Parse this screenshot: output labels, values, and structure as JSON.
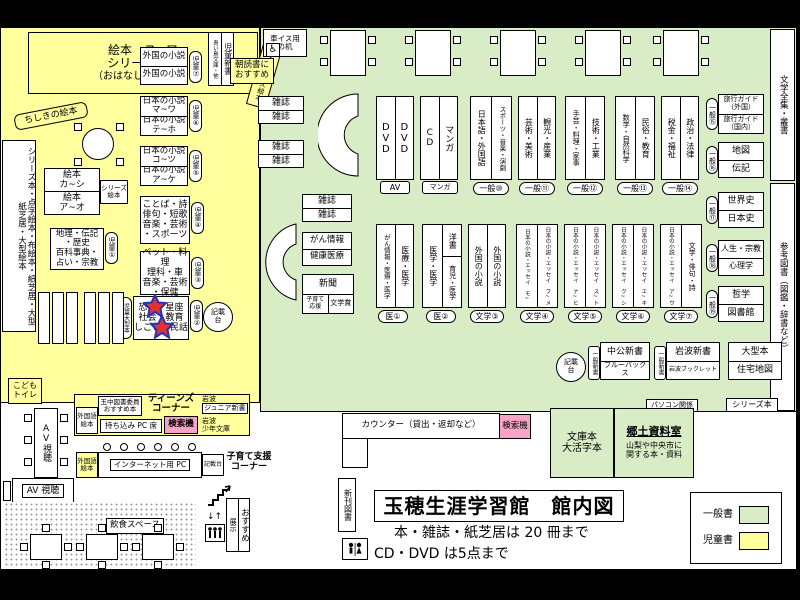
{
  "colors": {
    "children_bg": "#ffff9e",
    "general_bg": "#d8edc6",
    "search_pink": "#f9a3c6",
    "wall": "#000000"
  },
  "header": {
    "title": "玉穂生涯学習館　館内図",
    "rule_books": "本・雑誌・紙芝居は 20 冊まで",
    "rule_av": "CD・DVD は5点まで"
  },
  "legend": {
    "general": "一般書",
    "children": "児童書"
  },
  "children": {
    "ohanashi": {
      "l1": "絵本　ス~ワ",
      "l2": "シリーズ絵本",
      "l3": "（おはなしコーナー）"
    },
    "mukashi": "昔話・シリーズ絵本",
    "chishiki": "ちしきの絵本",
    "foreign": {
      "r1": "外国の小説",
      "r2": "外国の小説",
      "tag": "児童⑦"
    },
    "shinsho": {
      "main": "児童新書",
      "sub": "青い鳥文庫・他"
    },
    "asadoku": {
      "l1": "朝読書に",
      "l2": "おすすめ"
    },
    "jp1": {
      "r1": "日本の小説",
      "r2": "マ~ワ",
      "r3": "日本の小説",
      "r4": "テ~ホ",
      "tag": "児童⑥"
    },
    "jp2": {
      "r1": "日本の小説",
      "r2": "コ~ツ",
      "r3": "日本の小説",
      "r4": "ア~ケ",
      "tag": "児童⑤"
    },
    "kotoba": {
      "r1": "ことば・詩",
      "r2": "俳句・短歌",
      "r3": "音楽・芸術",
      "r4": "・スポーツ",
      "tag": "児童④"
    },
    "pet": {
      "r1": "ペット・料理",
      "r2": "理科・車",
      "r3": "音楽・芸術",
      "r4": "・保健",
      "tag": "児童③"
    },
    "star": {
      "r1": "恐竜・星座",
      "r2": "社会・教育",
      "r3": "しごと・民話",
      "tag": "児童②",
      "side": "児童大型本"
    },
    "chiri": {
      "r1": "地理・伝記",
      "r2": "・歴史",
      "r3": "百科事典・",
      "r4": "占い・宗教",
      "tag": "児童①"
    },
    "ehon1": {
      "l1": "絵本",
      "l2": "カ~シ"
    },
    "ehon2": {
      "l1": "絵本",
      "l2": "ア~オ"
    },
    "series_ehon": {
      "l1": "シリーズ",
      "l2": "絵本"
    },
    "tall_shelf": "シリーズ本・点字絵本・布絵本・紙芝居・大型紙芝居・大型絵本",
    "kisaidai": {
      "l1": "記載",
      "l2": "台"
    }
  },
  "general": {
    "wheelchair": {
      "l1": "車イス用",
      "l2": "の机"
    },
    "mag": "雑誌",
    "av": {
      "c1": "DVD",
      "c2": "DVD",
      "tag": "AV"
    },
    "cd": {
      "c1": "CD",
      "c2": "マンガ",
      "tag": "マンガ"
    },
    "s10": {
      "c1": "日本語・外国語",
      "c2": "スポーツ・音楽・演劇",
      "tag": "一般⑩"
    },
    "s11": {
      "c1": "芸術・美術",
      "c2": "観光・産業",
      "tag": "一般⑪"
    },
    "s12": {
      "c1": "手芸・料理・家事",
      "c2": "技術・工業",
      "tag": "一般⑫"
    },
    "s13": {
      "c1": "数学・自然科学",
      "c2": "民俗・教育",
      "tag": "一般⑬"
    },
    "s14": {
      "c1": "税金・福祉",
      "c2": "政治・法律",
      "tag": "一般⑭"
    },
    "r15": {
      "r1": "旅行ガイド（外国）",
      "r2": "旅行ガイド（国内）",
      "tag": "一般⑮"
    },
    "r16": {
      "r1": "地図",
      "r2": "伝記",
      "tag": "一般⑯"
    },
    "r17": {
      "r1": "世界史",
      "r2": "日本史",
      "tag": "一般⑰"
    },
    "r18": {
      "r1": "人生・宗教",
      "r2": "心理学",
      "tag": "一般⑱"
    },
    "r19": {
      "r1": "哲学",
      "r2": "図書館",
      "tag": "一般⑲"
    },
    "zenshu": "文学全集・叢書",
    "sanko": "参考図書（図鑑・辞書など）",
    "gan": {
      "r1": "がん情報",
      "r2": "健康医療"
    },
    "np": {
      "main": "新聞",
      "sub1a": "子育て",
      "sub1b": "応援",
      "sub2": "文学賞"
    },
    "m1": {
      "c1": "がん情報・医療・医学",
      "c2": "医療・医学",
      "tag": "医①"
    },
    "m2": {
      "c1": "医学・医学",
      "c2a": "洋書",
      "c2b": "育児・医学",
      "tag": "医②"
    },
    "b3": {
      "c1": "外国の小説",
      "c2": "外国の小説",
      "tag": "文学③"
    },
    "b4": {
      "c1": "日本の小説・エッセイ　モ~",
      "c2": "日本の小説・エッセイ　フ~メ",
      "tag": "文学④"
    },
    "b5": {
      "c1": "日本の小説・エッセイ　ナ~ヒ",
      "c2": "日本の小説・エッセイ　ス~ト",
      "tag": "文学⑤"
    },
    "b6": {
      "c1": "日本の小説・エッセイ　ク~シ",
      "c2": "日本の小説・エッセイ　エ~キ",
      "tag": "文学⑥"
    },
    "b7": {
      "c1": "日本の小説・エッセイ　ア~ウ",
      "c2": "文学・俳句・詩",
      "tag": "文学⑦"
    },
    "sh1": {
      "r1": "中公新書",
      "r2": "ブルーバックス",
      "tag": "一般新書"
    },
    "sh2": {
      "r1": "岩波新書",
      "r2": "岩波ブックレット",
      "tag": "一般新書"
    },
    "big": {
      "r1": "大型本",
      "r2": "住宅地図"
    },
    "pc": "パソコン関係",
    "series": "シリーズ本",
    "kisaidai": {
      "l1": "記載",
      "l2": "台"
    }
  },
  "south": {
    "counter": "カウンター（貸出・返却など）",
    "search": "検索機",
    "shinkan": "新刊図書",
    "bunko": {
      "l1": "文庫本",
      "l2": "大活字本"
    },
    "kyodo": {
      "title": "郷土資料室",
      "d1": "山梨や中央市に",
      "d2": "関する本・資料"
    },
    "kids_wc": {
      "l1": "こども",
      "l2": "トイレ"
    },
    "av_table": "AV視聴",
    "av_box": "AV 視聴",
    "gaikokugo": {
      "l1": "外国語",
      "l2": "絵本"
    },
    "committee": {
      "l1": "玉中図書委員",
      "l2": "おすすめ本"
    },
    "teens": {
      "l1": "ティーンズ",
      "l2": "コーナー"
    },
    "junior": {
      "l1": "岩波",
      "l2": "ジュニア新書"
    },
    "byod": "持ち込み PC 席",
    "search2": "検索機",
    "shonen": {
      "l1": "岩波",
      "l2": "少年文庫"
    },
    "net_pc": "インターネット用 PC",
    "kisaidai": "記載台",
    "kosodate": {
      "l1": "子育て支援",
      "l2": "コーナー"
    },
    "osusume": {
      "l1": "おすすめ",
      "l2": "展示"
    },
    "inshoku": "飲食スペース"
  }
}
